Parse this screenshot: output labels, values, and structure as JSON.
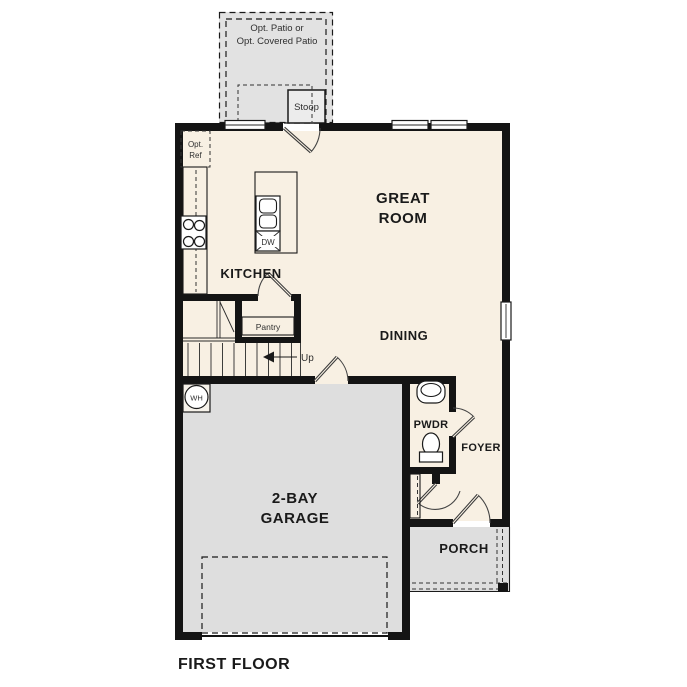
{
  "title": "FIRST FLOOR",
  "labels": {
    "patio_line1": "Opt. Patio or",
    "patio_line2": "Opt. Covered Patio",
    "stoop": "Stoop",
    "opt_ref_line1": "Opt.",
    "opt_ref_line2": "Ref",
    "great_room_line1": "GREAT",
    "great_room_line2": "ROOM",
    "kitchen": "KITCHEN",
    "dishwasher": "DW",
    "pantry": "Pantry",
    "stairs_up": "Up",
    "dining": "DINING",
    "powder": "PWDR",
    "foyer": "FOYER",
    "water_heater": "WH",
    "garage_line1": "2-BAY",
    "garage_line2": "GARAGE",
    "porch": "PORCH"
  },
  "colors": {
    "wall": "#141414",
    "floor": "#f8f0e3",
    "hardscape": "#e2e2e2",
    "garage_floor": "#dedede",
    "casework": "#cdbb9f",
    "fixture_blue": "#a9c7e3",
    "text": "#1a1a1a"
  }
}
